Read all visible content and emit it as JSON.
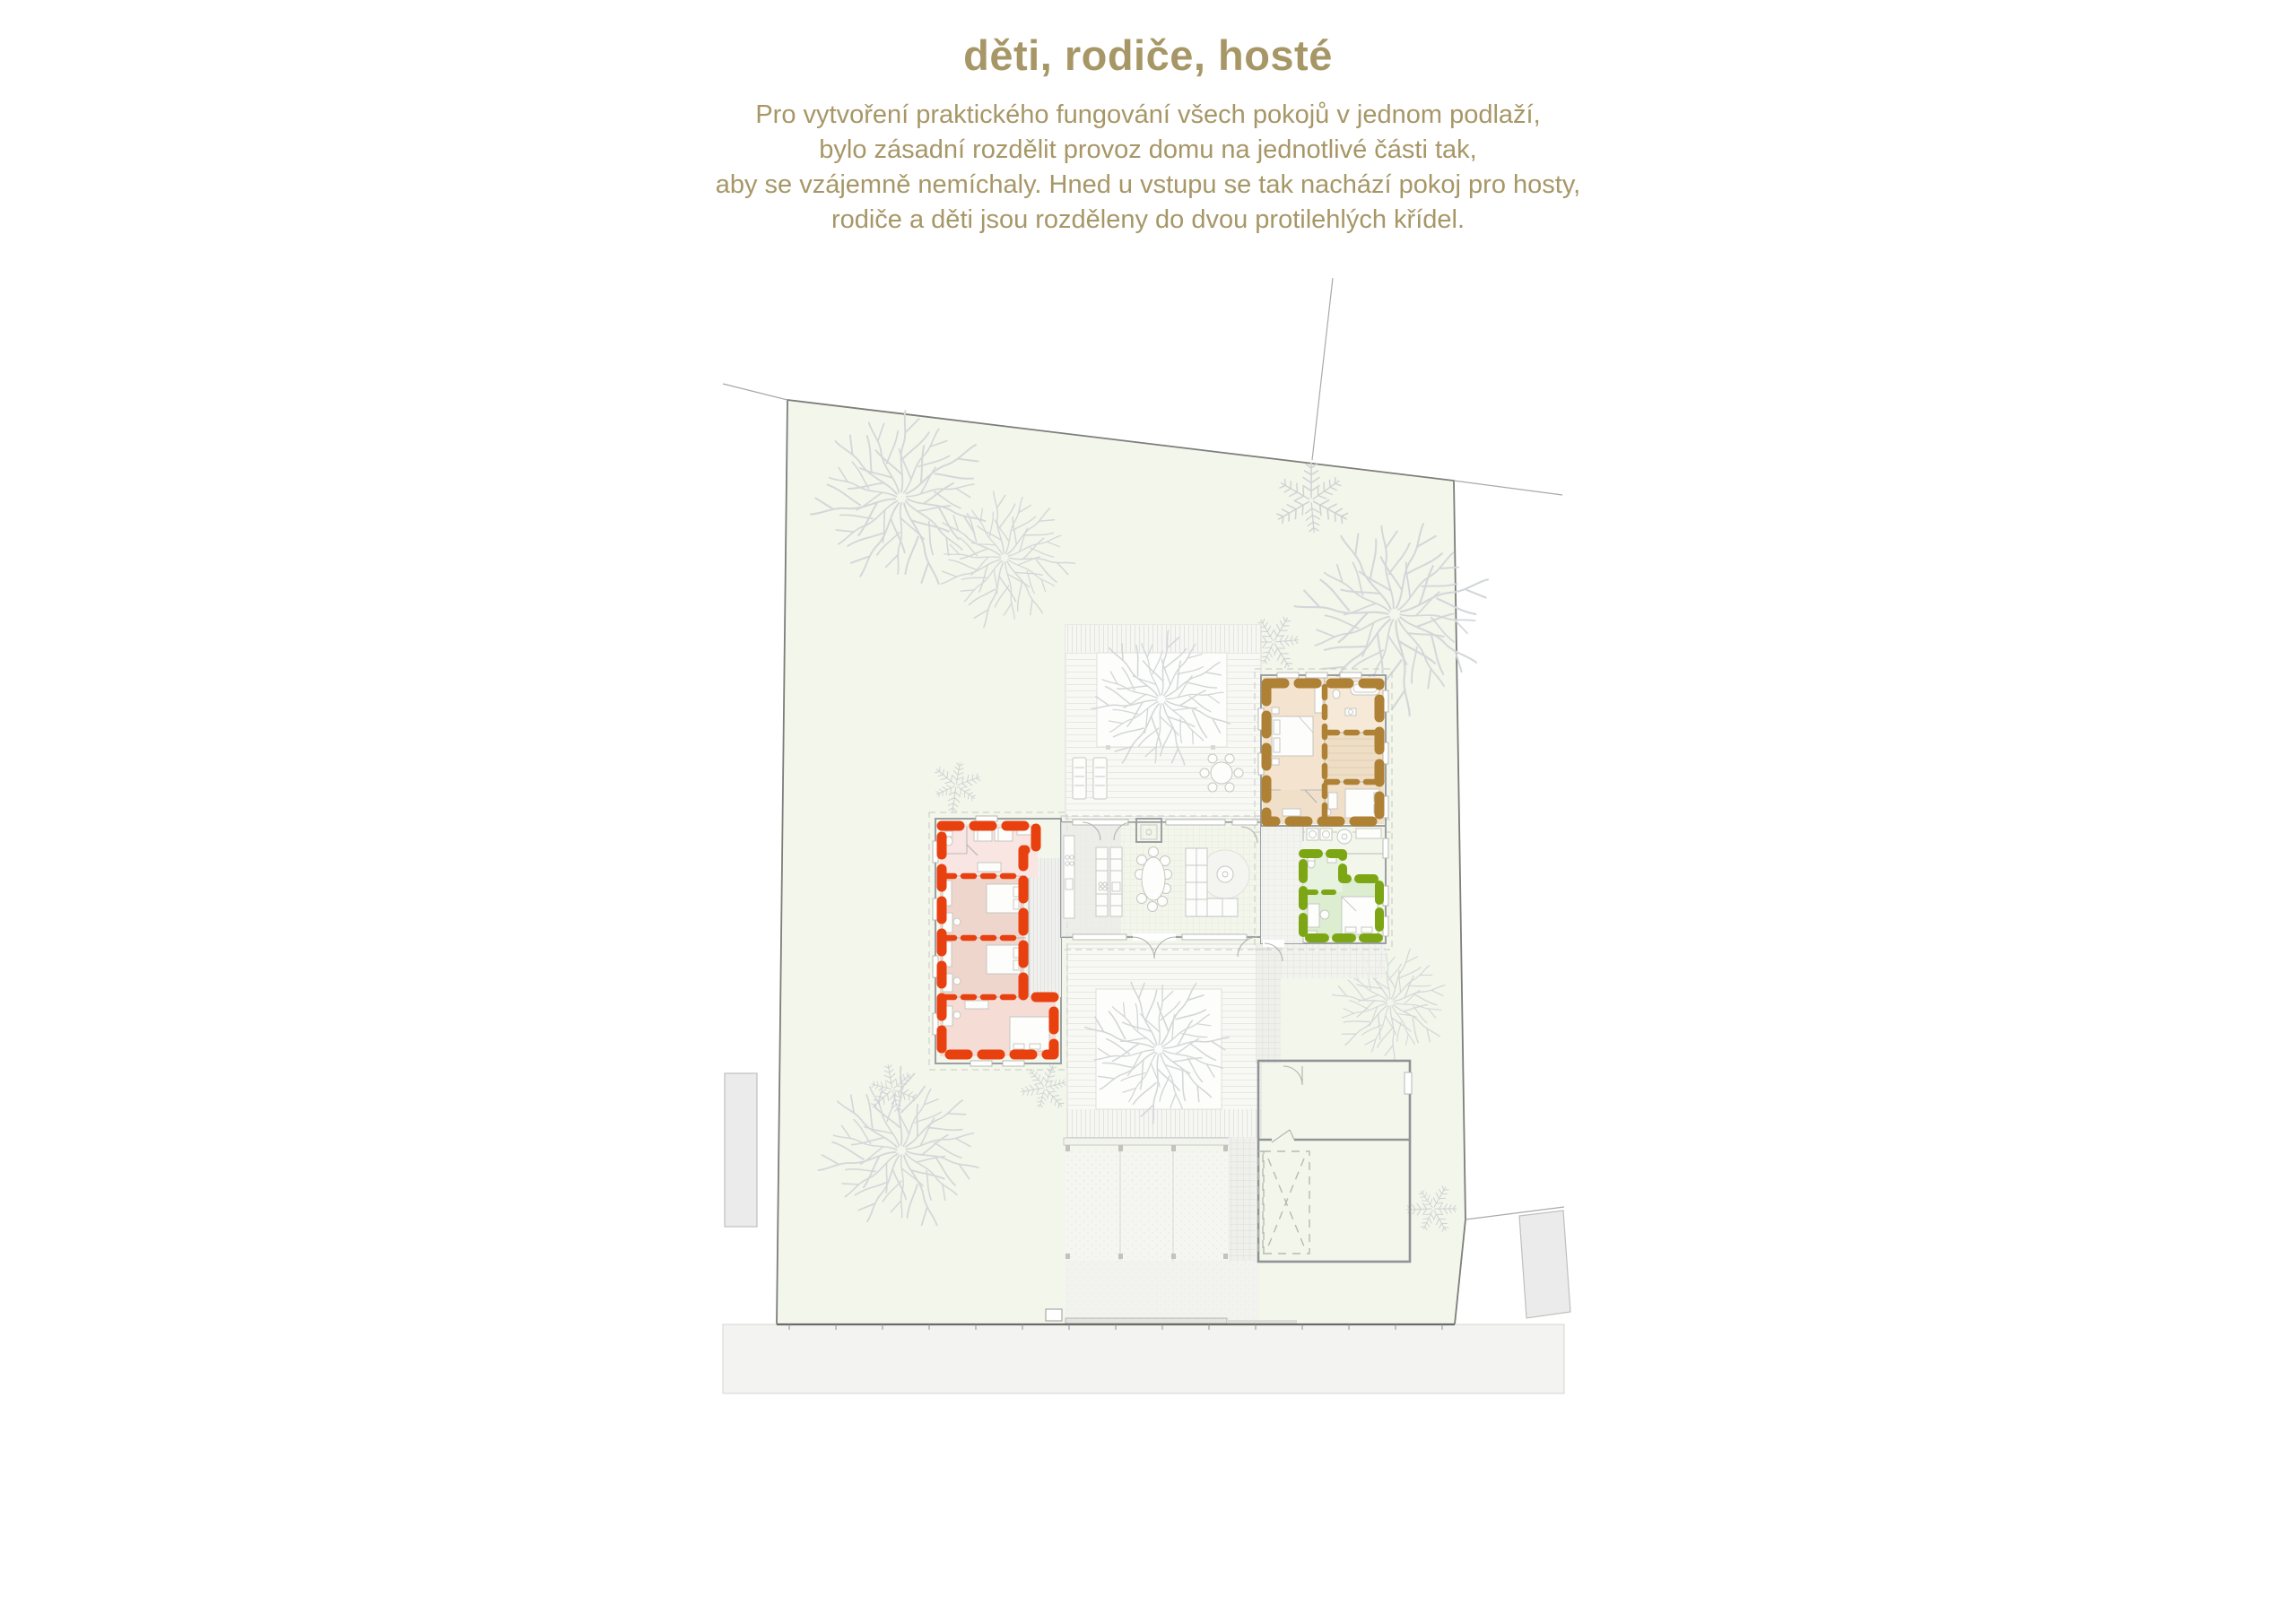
{
  "header": {
    "title": "děti, rodiče, hosté",
    "lines": [
      "Pro vytvoření praktického fungování všech pokojů v jednom podlaží,",
      "bylo zásadní rozdělit provoz domu na jednotlivé části tak,",
      "aby se vzájemně nemíchaly. Hned u vstupu se tak nachází pokoj pro hosty,",
      "rodiče a děti jsou rozděleny do dvou protilehlých křídel."
    ]
  },
  "theme": {
    "text_color": "#a79767",
    "plot_fill": "#f3f6ea",
    "zone_children": "#e8400f",
    "zone_parents": "#ae8134",
    "zone_guests": "#7da615",
    "road_fill": "#f3f3f2",
    "neighbor_fill": "#ebebeb",
    "tree_stroke": "#d3d7d9",
    "wall_stroke": "#9aa0a3"
  },
  "plan": {
    "zones": [
      {
        "id": "children",
        "title_word": "děti",
        "color": "#e8400f"
      },
      {
        "id": "parents",
        "title_word": "rodiče",
        "color": "#ae8134"
      },
      {
        "id": "guests",
        "title_word": "hosté",
        "color": "#7da615"
      }
    ]
  }
}
